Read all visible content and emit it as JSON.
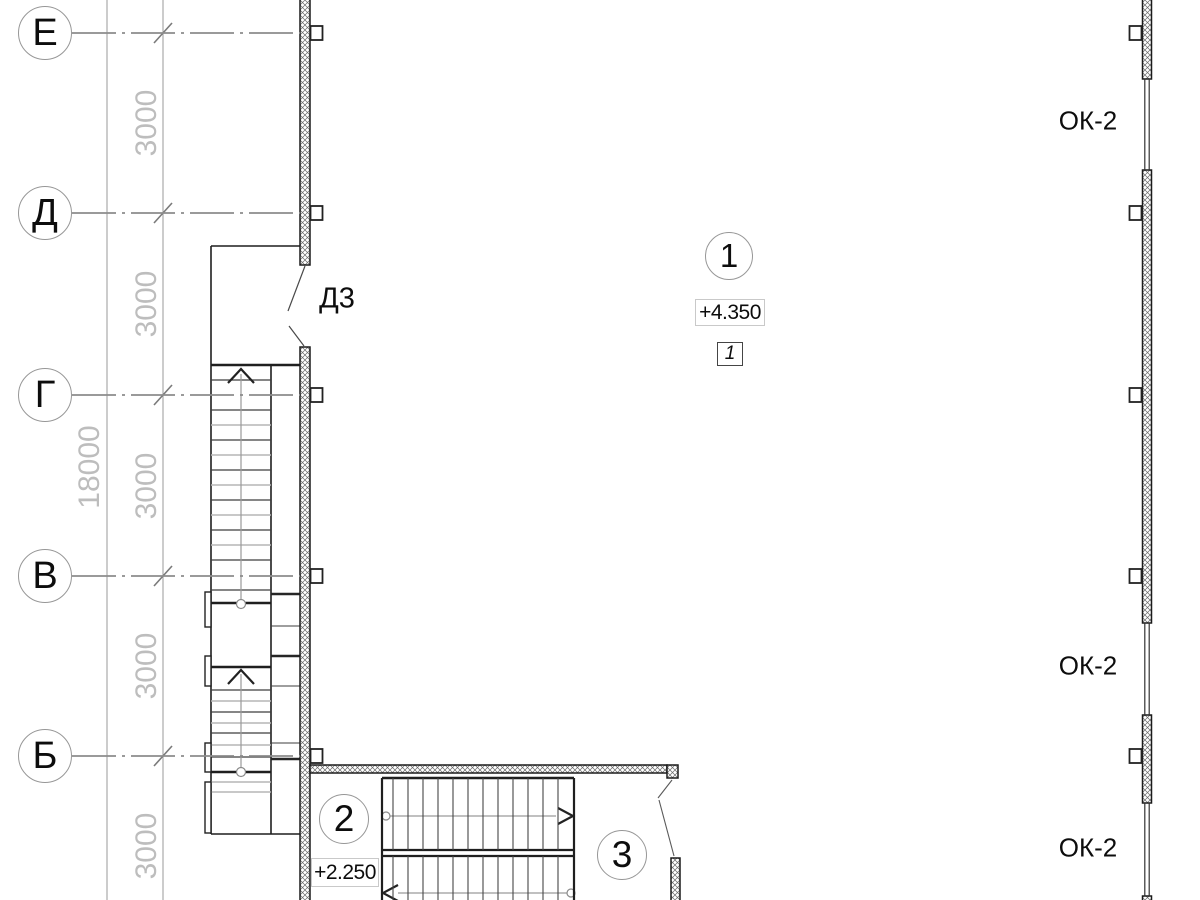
{
  "grid": {
    "axes": [
      {
        "label": "Е"
      },
      {
        "label": "Д"
      },
      {
        "label": "Г"
      },
      {
        "label": "В"
      },
      {
        "label": "Б"
      }
    ],
    "bay_dimensions": [
      "3000",
      "3000",
      "3000",
      "3000",
      "3000"
    ],
    "overall_dimension": "18000"
  },
  "annotations": {
    "door_tag": "Д3",
    "window_tags": [
      "ОК-2",
      "ОК-2",
      "ОК-2"
    ],
    "rooms": [
      {
        "number": "1",
        "elevation": "+4.350",
        "detail_ref": "1"
      },
      {
        "number": "2",
        "elevation": "+2.250"
      },
      {
        "number": "3"
      }
    ]
  },
  "colors": {
    "wall_line": "#1b1b1b",
    "hatch_line": "#6a6a6a",
    "grid_line": "#8c8c8c",
    "dim_line": "#9a9a9a",
    "dim_text": "#bdbdbd",
    "annotation_text": "#0d0d0d",
    "background": "#ffffff"
  }
}
